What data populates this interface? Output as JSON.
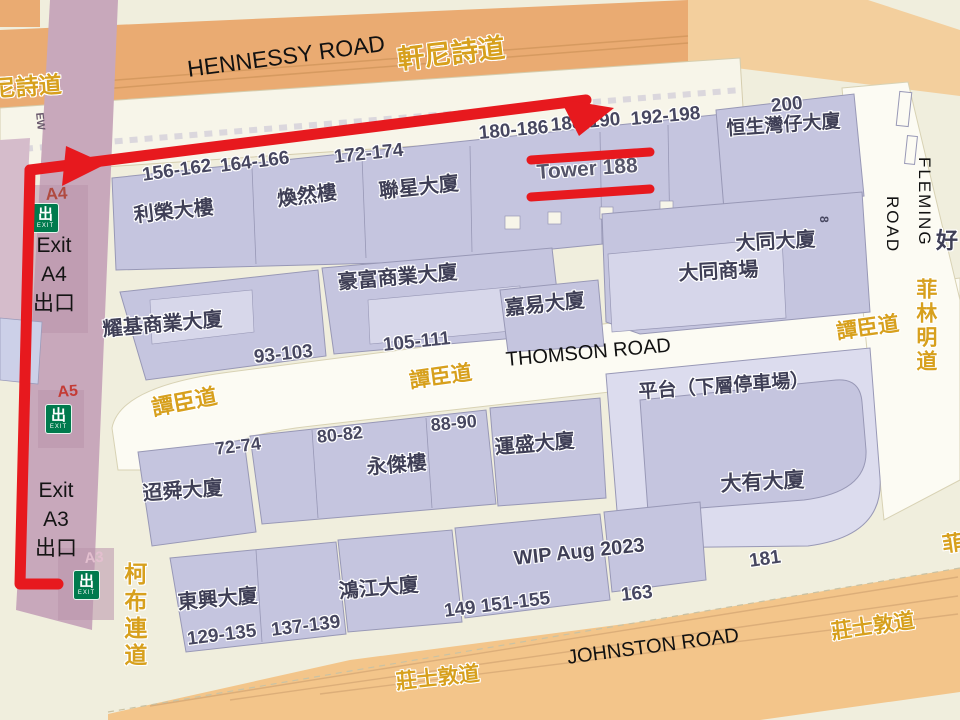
{
  "colors": {
    "route_red": "#e7191e",
    "exit_green": "#007a4d",
    "street_label_yellow": "#d7a01d",
    "main_road_orange": "#eaab72",
    "secondary_orange": "#f3c58a",
    "building_lavender": "#c5c5df",
    "mtr_purple": "#c8a8bb",
    "background_cream": "#f0eedd"
  },
  "streets": {
    "hennessy_en": "HENNESSY ROAD",
    "hennessy_zh": "軒尼詩道",
    "hennessy_zh_partial": "尼詩道",
    "thomson_en": "THOMSON ROAD",
    "thomson_zh_west": "譚臣道",
    "thomson_zh_mid": "譚臣道",
    "thomson_zh_east": "譚臣道",
    "johnston_en": "JOHNSTON ROAD",
    "johnston_zh_mid": "莊士敦道",
    "johnston_zh_east": "莊士敦道",
    "fleming_en_word1": "FLEMING",
    "fleming_en_word2": "ROAD",
    "fleming_zh": "菲林明道",
    "obrien_zh": "柯布連道",
    "road_marking_ew": "EW",
    "partial_char_ne": "好",
    "partial_char_se": "菲"
  },
  "buildings": {
    "lee_wing": "利榮大樓",
    "woon_yin": "煥然樓",
    "luen_sing": "聯星大廈",
    "tower188": "Tower 188",
    "hang_seng_wanchai": "恒生灣仔大廈",
    "tai_tung": "大同大廈",
    "tai_tung_mall": "大同商場",
    "yiu_kei": "耀基商業大廈",
    "ho_fu": "豪富商業大廈",
    "ka_yee": "嘉易大廈",
    "tiu_shun": "迢舜大廈",
    "wing_kit": "永傑樓",
    "wan_shing": "運盛大廈",
    "tai_yau": "大有大廈",
    "tung_hing": "東興大廈",
    "hung_kong": "鴻江大廈"
  },
  "annotations": {
    "podium": "平台（下層停車場）",
    "wip": "WIP Aug 2023",
    "side_number_8": "8"
  },
  "numbers": {
    "n156": "156-162",
    "n164": "164-166",
    "n172": "172-174",
    "n180": "180-186",
    "n188": "188-190",
    "n192": "192-198",
    "n200": "200",
    "n93": "93-103",
    "n105": "105-111",
    "n72": "72-74",
    "n80": "80-82",
    "n88": "88-90",
    "n129": "129-135",
    "n137": "137-139",
    "n149": "149 151-155",
    "n163": "163",
    "n181": "181"
  },
  "exits": {
    "icon_char": "出",
    "icon_word": "EXIT",
    "a4_code": "A4",
    "a5_code": "A5",
    "a3_code": "A3",
    "a4_lines": [
      "Exit",
      "A4",
      "出口"
    ],
    "a3_lines": [
      "Exit",
      "A3",
      "出口"
    ]
  }
}
